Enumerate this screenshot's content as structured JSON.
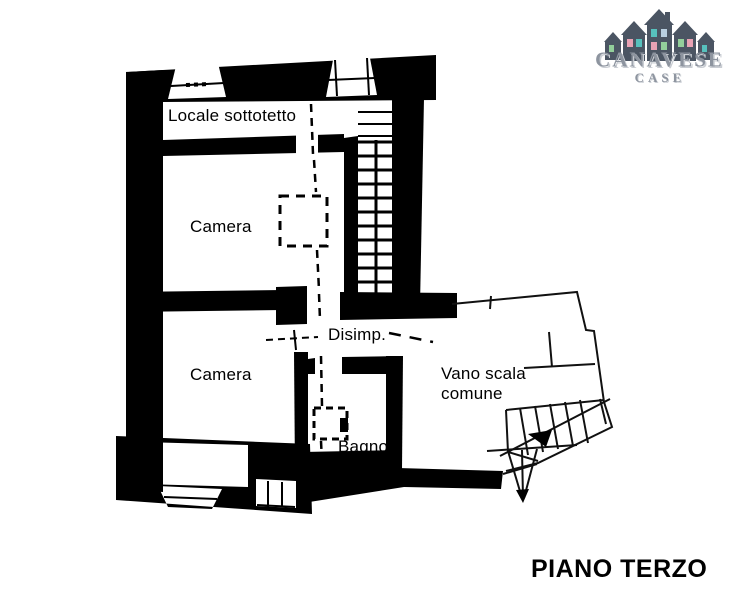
{
  "logo": {
    "name": "CANAVESE",
    "subname": "CASE",
    "house_color": "#4b5563",
    "window_colors": [
      "#57c1bd",
      "#e8a2b4",
      "#93cf9b",
      "#b9cfe0"
    ],
    "text_color": "#9198a3"
  },
  "plan": {
    "ink_color": "#000000",
    "labels": {
      "attic_room": "Locale sottotetto",
      "bedroom_upper": "Camera",
      "bedroom_lower": "Camera",
      "hallway": "Disimp.",
      "bathroom": "Bagno",
      "stairwell_line1": "Vano scala",
      "stairwell_line2": "comune"
    }
  },
  "caption": {
    "title": "PIANO TERZO"
  }
}
